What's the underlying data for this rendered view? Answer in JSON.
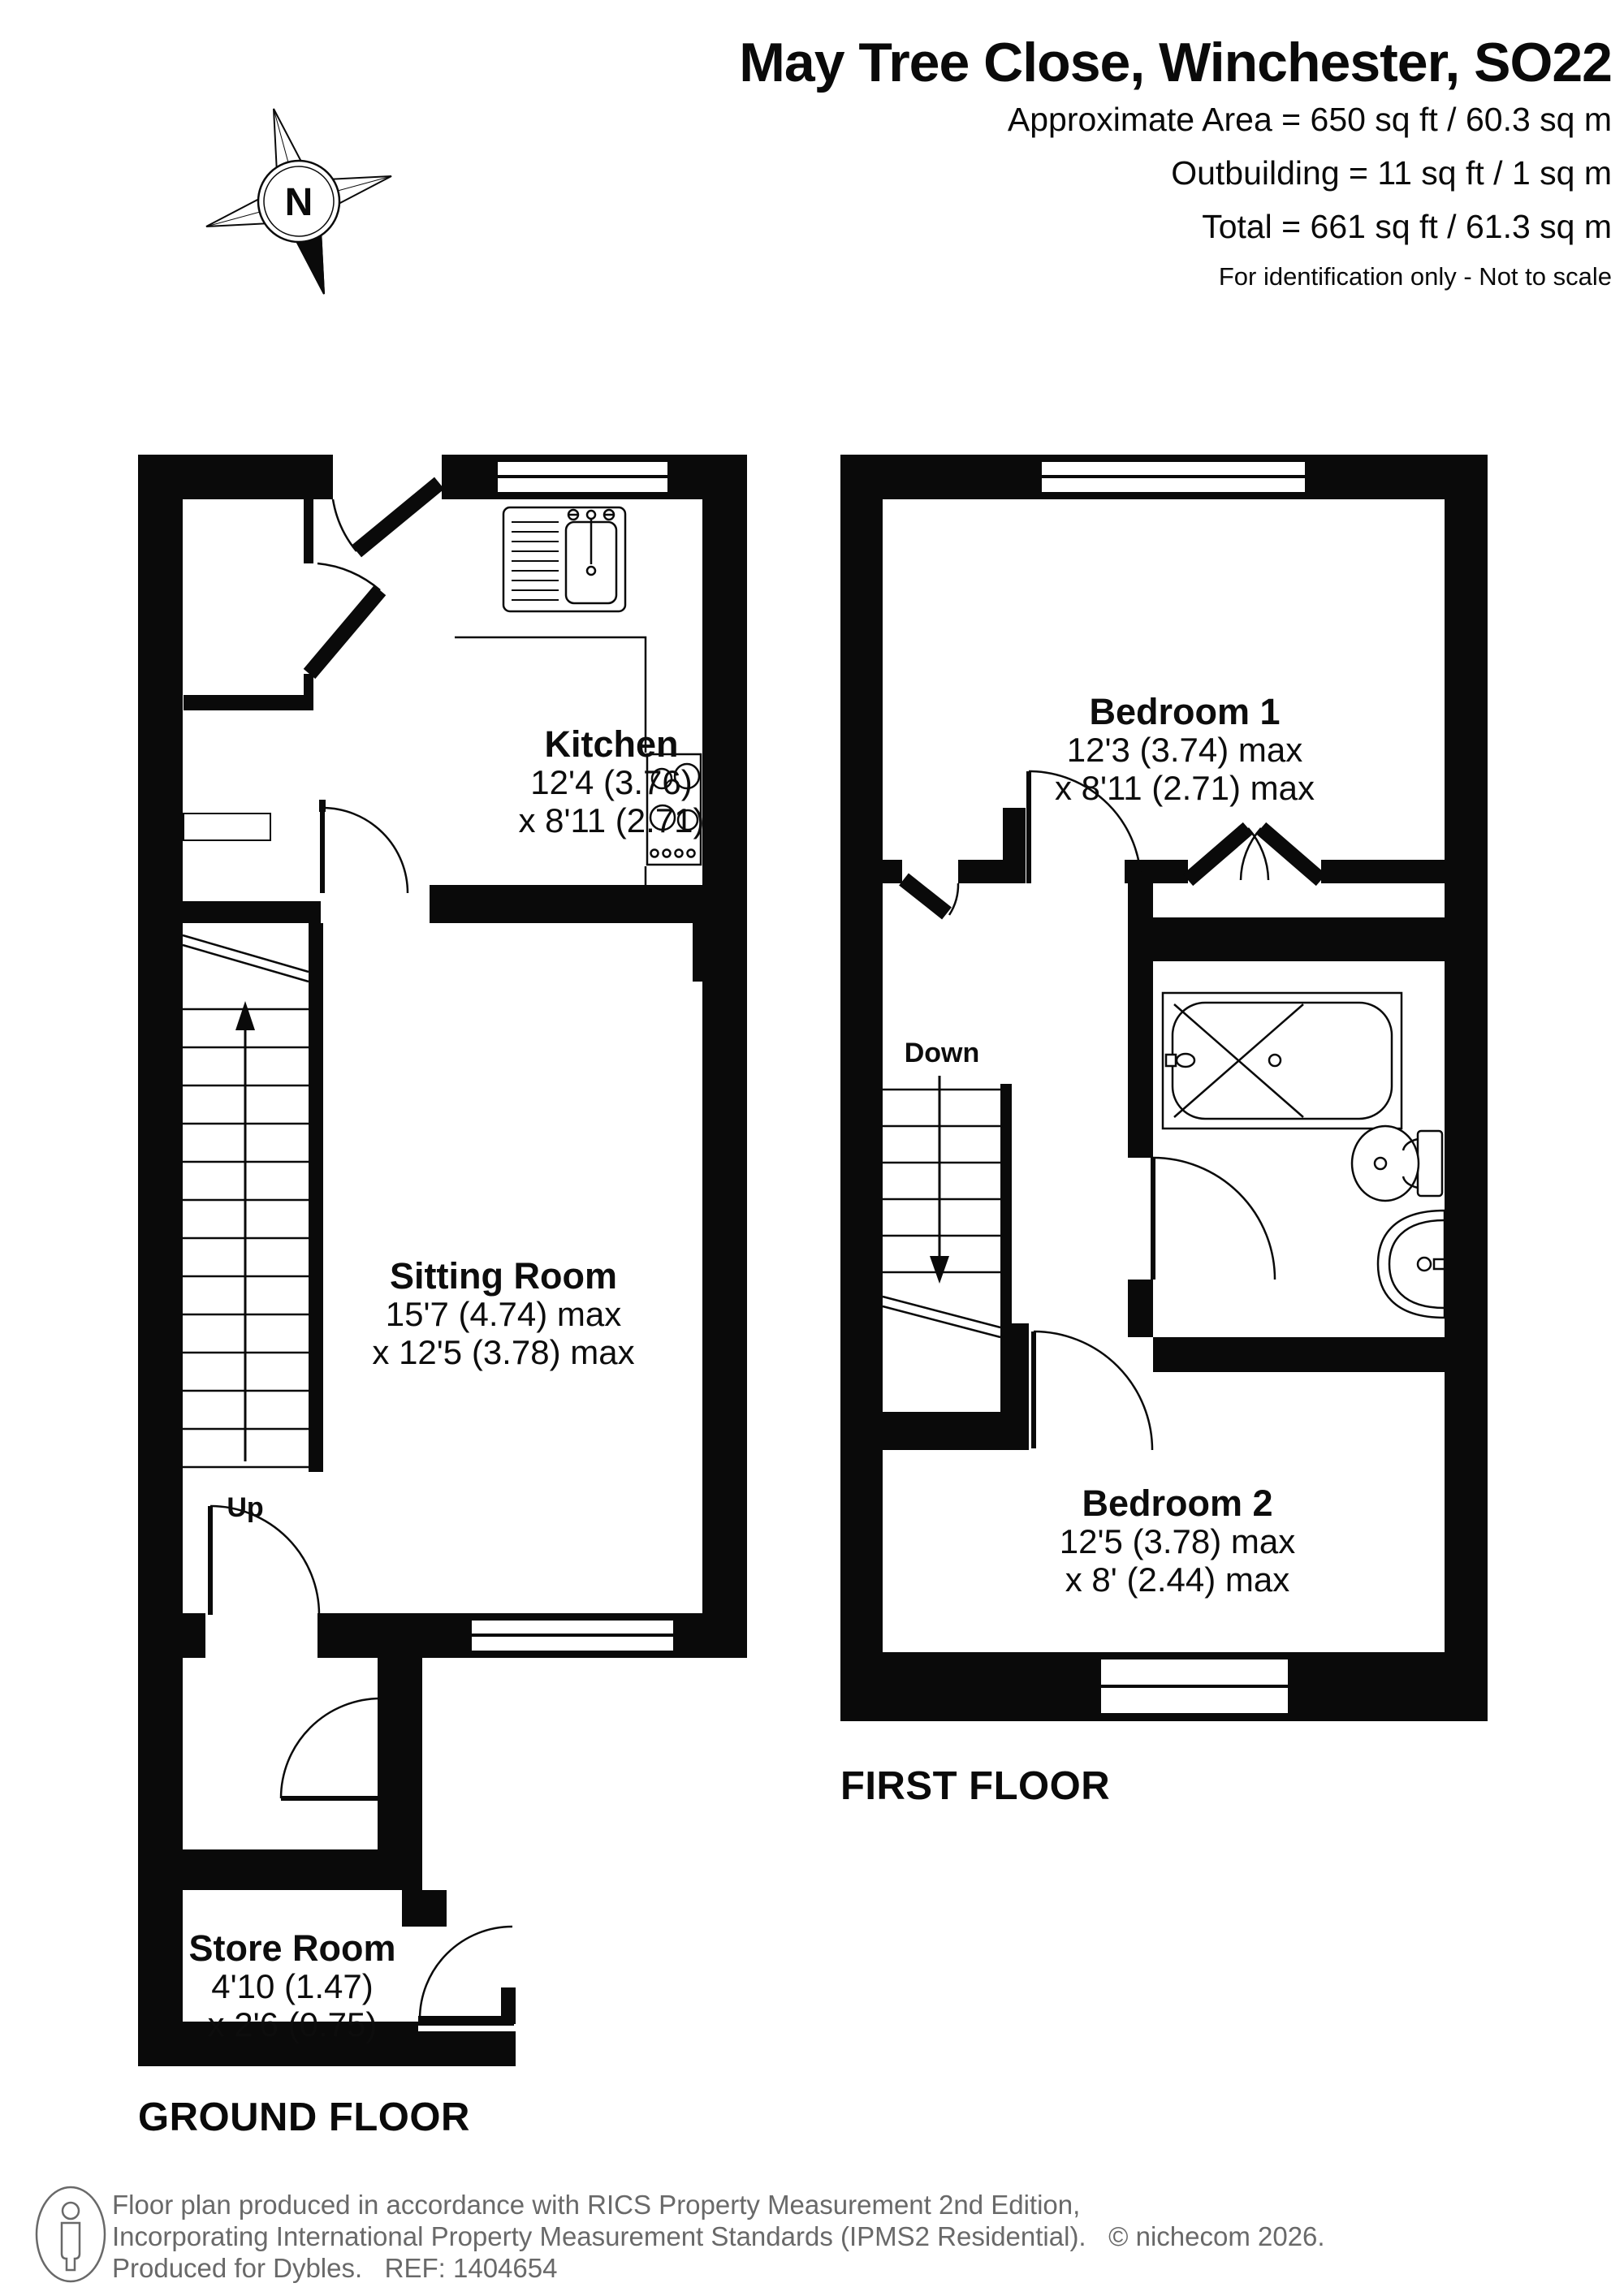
{
  "header": {
    "title": "May Tree Close, Winchester, SO22",
    "area_line": "Approximate Area = 650 sq ft / 60.3 sq m",
    "outbuilding_line": "Outbuilding = 11 sq ft / 1 sq m",
    "total_line": "Total = 661 sq ft / 61.3 sq m",
    "disclaimer": "For identification only - Not to scale",
    "compass_label": "N"
  },
  "ground_floor": {
    "caption": "GROUND FLOOR",
    "stairs_label": "Up",
    "rooms": {
      "kitchen": {
        "name": "Kitchen",
        "dim1": "12'4 (3.76)",
        "dim2": "x 8'11 (2.71)"
      },
      "sitting": {
        "name": "Sitting Room",
        "dim1": "15'7 (4.74) max",
        "dim2": "x 12'5 (3.78) max"
      },
      "store": {
        "name": "Store Room",
        "dim1": "4'10 (1.47)",
        "dim2": "x 2'6 (0.75)"
      }
    }
  },
  "first_floor": {
    "caption": "FIRST FLOOR",
    "stairs_label": "Down",
    "rooms": {
      "bedroom1": {
        "name": "Bedroom 1",
        "dim1": "12'3 (3.74) max",
        "dim2": "x 8'11 (2.71) max"
      },
      "bedroom2": {
        "name": "Bedroom 2",
        "dim1": "12'5 (3.78) max",
        "dim2": "x 8' (2.44) max"
      }
    }
  },
  "footer": {
    "line1": "Floor plan produced in accordance with RICS Property Measurement 2nd Edition,",
    "line2": "Incorporating International Property Measurement Standards (IPMS2 Residential).   © nichecom 2026.",
    "line3": "Produced for Dybles.   REF: 1404654"
  },
  "colors": {
    "wall": "#0a0a0a",
    "footer_text": "#696969",
    "background": "#ffffff"
  }
}
